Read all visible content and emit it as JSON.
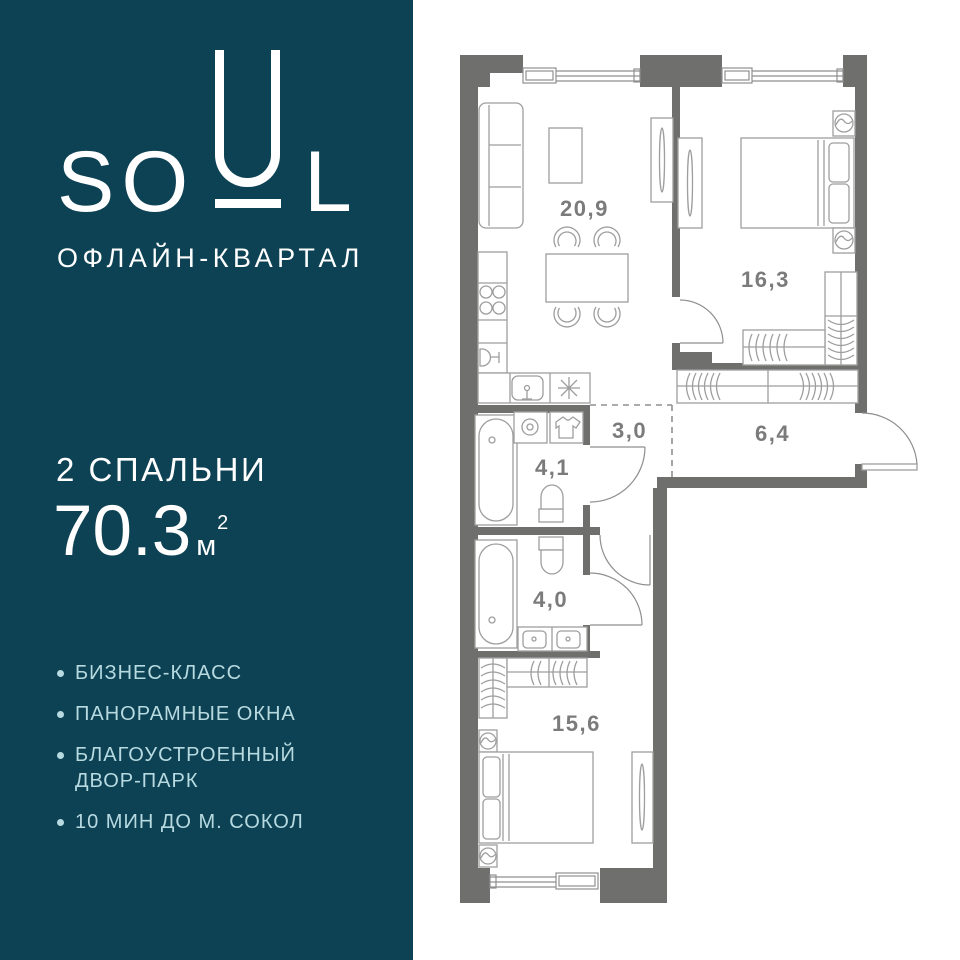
{
  "brand": {
    "so": "SO",
    "u": "U",
    "l": "L",
    "subtitle": "ОФЛАЙН-КВАРТАЛ"
  },
  "listing": {
    "bedrooms": "2 СПАЛЬНИ",
    "area_number": "70.3",
    "area_unit": "м",
    "area_exponent": "2"
  },
  "features": [
    {
      "label": "БИЗНЕС-КЛАСС"
    },
    {
      "label": "ПАНОРАМНЫЕ ОКНА"
    },
    {
      "label": "БЛАГОУСТРОЕННЫЙ ДВОР-ПАРК"
    },
    {
      "label": "10 МИН ДО М. СОКОЛ"
    }
  ],
  "floorplan": {
    "rooms": [
      {
        "name": "living-kitchen",
        "area_label": "20,9"
      },
      {
        "name": "bedroom-1",
        "area_label": "16,3"
      },
      {
        "name": "corridor",
        "area_label": "3,0"
      },
      {
        "name": "hallway",
        "area_label": "6,4"
      },
      {
        "name": "bathroom-1",
        "area_label": "4,1"
      },
      {
        "name": "bathroom-2",
        "area_label": "4,0"
      },
      {
        "name": "bedroom-2",
        "area_label": "15,6"
      }
    ],
    "total_area": "70,3"
  },
  "colors": {
    "panel_bg": "#0d4254",
    "panel_text": "#ffffff",
    "feature_text": "#b7dae1",
    "wall": "#6f6f6e",
    "furniture_line": "#9e9e9e",
    "room_label": "#7b7b7b",
    "plan_bg": "#ffffff"
  }
}
